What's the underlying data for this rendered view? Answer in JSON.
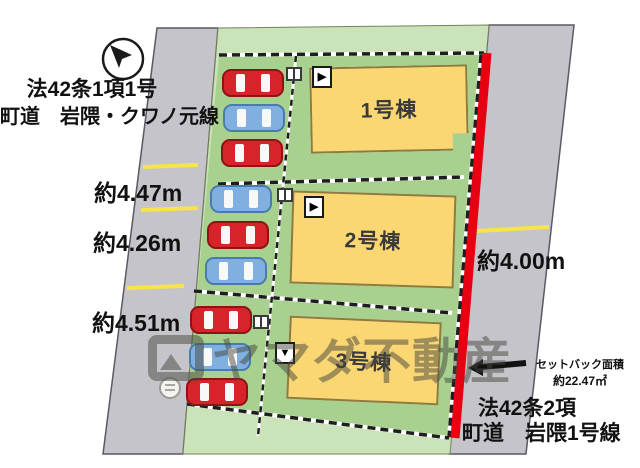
{
  "plan": {
    "left_road": {
      "law": "法42条1項1号",
      "name": "町道　岩隈・クワノ元線",
      "width_labels": [
        "約4.47m",
        "約4.26m",
        "約4.51m"
      ]
    },
    "right_road": {
      "law": "法42条2項",
      "name": "町道　岩隈1号線",
      "width_label": "約4.00m"
    },
    "setback": {
      "title": "セットバック面積",
      "area": "約22.47㎡"
    },
    "buildings": [
      {
        "label": "1号棟"
      },
      {
        "label": "2号棟"
      },
      {
        "label": "3号棟"
      }
    ],
    "parking": {
      "cars": [
        {
          "lot": 1,
          "color": "red"
        },
        {
          "lot": 1,
          "color": "blue"
        },
        {
          "lot": 1,
          "color": "red"
        },
        {
          "lot": 2,
          "color": "blue"
        },
        {
          "lot": 2,
          "color": "red"
        },
        {
          "lot": 2,
          "color": "blue"
        },
        {
          "lot": 3,
          "color": "red"
        },
        {
          "lot": 3,
          "color": "blue"
        },
        {
          "lot": 3,
          "color": "red"
        }
      ]
    },
    "watermark": "ヤマダ不動産",
    "icons": {
      "north_arrow": "compass-needle-nw",
      "entrance_right": "▶",
      "entrance_down": "▼",
      "setback_arrow": "left-black-arrow"
    },
    "colors": {
      "site_margin": "#cbe3b8",
      "lot_green": "#a8d18f",
      "road_gray": "#c5c4ca",
      "building_fill": "#fbd773",
      "setback_line_red": "#e60012",
      "car_red": "#d7232a",
      "car_blue": "#7fb0e0",
      "lane_mark_yellow": "#f8e34d"
    }
  }
}
